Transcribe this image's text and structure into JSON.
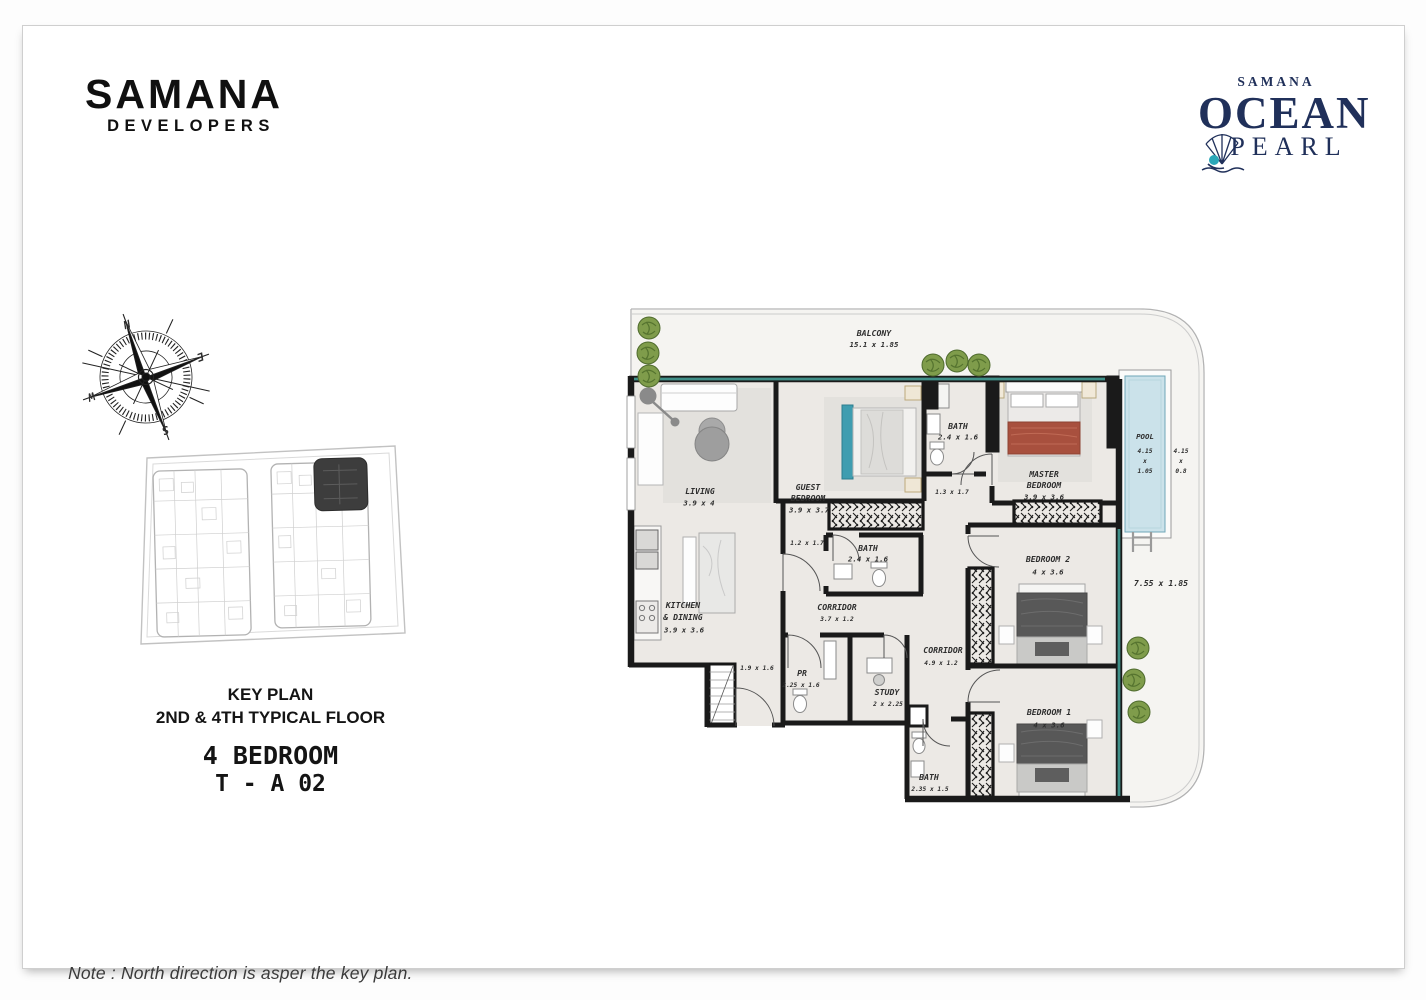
{
  "brand": {
    "name": "SAMANA",
    "tagline": "DEVELOPERS"
  },
  "project": {
    "eyebrow": "SAMANA",
    "title": "OCEAN",
    "subtitle": "PEARL"
  },
  "key_plan": {
    "title": "KEY PLAN",
    "subtitle": "2ND & 4TH TYPICAL FLOOR",
    "unit_type": "4 BEDROOM",
    "unit_code": "T - A 02"
  },
  "compass": {
    "north": "N",
    "east": "E",
    "south": "S",
    "west": "W"
  },
  "note": "Note : North direction is asper the key plan.",
  "colors": {
    "wall": "#1a1a1a",
    "window_teal": "#3f8f88",
    "pool_water": "#cbe2ea",
    "brand_navy": "#20305a",
    "pearl_teal": "#2aa7b8",
    "plan_floor": "#ece9e5",
    "balcony_floor": "#f5f4f1"
  },
  "plan": {
    "balcony_top": {
      "label": "BALCONY",
      "dims": "15.1 x 1.85"
    },
    "living": {
      "label": "LIVING",
      "dims": "3.9 x 4"
    },
    "guest_bedroom": {
      "label1": "GUEST",
      "label2": "BEDROOM",
      "dims": "3.9 x 3.7"
    },
    "bath_top": {
      "label": "BATH",
      "dims": "2.4 x 1.6"
    },
    "master_bedroom": {
      "label1": "MASTER",
      "label2": "BEDROOM",
      "dims": "3.9 x 3.6"
    },
    "pool": {
      "label": "POOL",
      "w": "4.15",
      "x": "x",
      "h": "1.05"
    },
    "pool_outer": {
      "w": "4.15",
      "x": "x",
      "h": "0.8"
    },
    "kitchen": {
      "label1": "KITCHEN",
      "label2": "& DINING",
      "dims": "3.9 x 3.6"
    },
    "bath_mid": {
      "label": "BATH",
      "dims": "2.4 x 1.6"
    },
    "corridor": {
      "label": "CORRIDOR",
      "dims": "3.7 x 1.2"
    },
    "corridor_right": {
      "label": "CORRIDOR",
      "dims": "4.9 x 1.2"
    },
    "pr": {
      "label": "PR",
      "dims": "2.25 x 1.6"
    },
    "study": {
      "label": "STUDY",
      "dims": "2 x 2.25"
    },
    "bedroom2": {
      "label": "BEDROOM 2",
      "dims": "4 x 3.6"
    },
    "bedroom1": {
      "label": "BEDROOM 1",
      "dims": "4 x 3.6"
    },
    "bath_bottom": {
      "label": "BATH",
      "dims": "2.35 x 1.5"
    },
    "balcony_right": {
      "dims": "7.55 x 1.85"
    },
    "dim_foyer": "1.2 x 1.7",
    "dim_hall": "1.3 x 1.7",
    "dim_entry": "1.9 x 1.6"
  }
}
